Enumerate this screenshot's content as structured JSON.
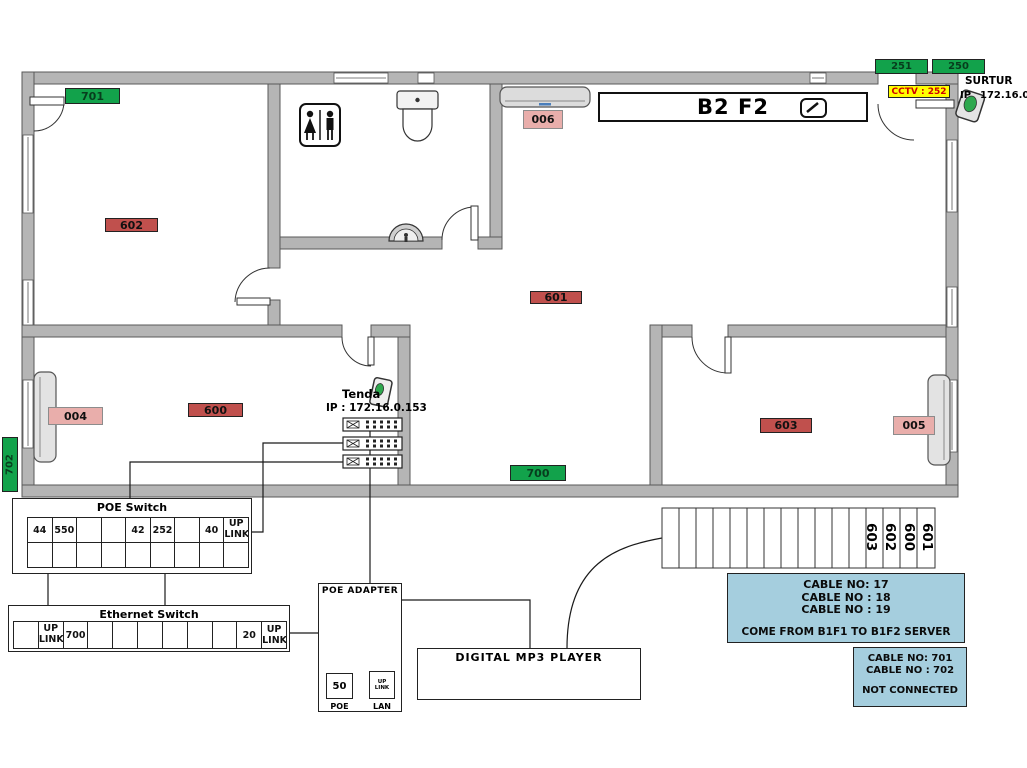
{
  "colors": {
    "wall": "#b5b5b5",
    "green": "#12a24b",
    "red": "#c0504d",
    "pink": "#e9aeab",
    "yellow": "#ffff00",
    "info_blue": "#a5cede",
    "accent_blue": "#4a7ebb"
  },
  "header": {
    "floor_title": "B2 F2"
  },
  "surtur": {
    "name": "SURTUR",
    "ip_label": "IP",
    "ip": "172.16.0.2"
  },
  "cctv": {
    "label": "CCTV : 252"
  },
  "room_labels": [
    {
      "text": "701",
      "color": "green"
    },
    {
      "text": "602",
      "color": "red"
    },
    {
      "text": "006",
      "color": "pink"
    },
    {
      "text": "601",
      "color": "red"
    },
    {
      "text": "004",
      "color": "pink"
    },
    {
      "text": "600",
      "color": "red"
    },
    {
      "text": "700",
      "color": "green"
    },
    {
      "text": "603",
      "color": "red"
    },
    {
      "text": "005",
      "color": "pink"
    },
    {
      "text": "702",
      "color": "green"
    },
    {
      "text": "251",
      "color": "green"
    },
    {
      "text": "250",
      "color": "green"
    }
  ],
  "tenda": {
    "name": "Tenda",
    "ip": "IP : 172.16.0.153"
  },
  "poe_switch": {
    "title": "POE Switch",
    "row1": [
      "44",
      "550",
      "",
      "",
      "42",
      "252",
      "",
      "40",
      "UP LINK"
    ],
    "row2": [
      "",
      "",
      "",
      "",
      "",
      "",
      "",
      "",
      ""
    ]
  },
  "ethernet_switch": {
    "title": "Ethernet Switch",
    "cells": [
      "",
      "UP LINK",
      "700",
      "",
      "",
      "",
      "",
      "",
      "",
      "20",
      "UP LINK"
    ]
  },
  "poe_adapter": {
    "title": "POE ADAPTER",
    "poe_value": "50",
    "poe_label": "POE",
    "lan_value": "UP LINK",
    "lan_label": "LAN"
  },
  "mp3_player": {
    "title": "DIGITAL MP3 PLAYER"
  },
  "stairs": {
    "labels": [
      "603",
      "602",
      "600",
      "601"
    ]
  },
  "info_boxes": [
    {
      "lines": [
        "CABLE NO: 17",
        "CABLE NO : 18",
        "CABLE NO : 19"
      ],
      "footer": "COME FROM B1F1 TO B1F2 SERVER"
    },
    {
      "lines": [
        "CABLE NO: 701",
        "CABLE NO : 702"
      ],
      "footer": "NOT CONNECTED"
    }
  ]
}
